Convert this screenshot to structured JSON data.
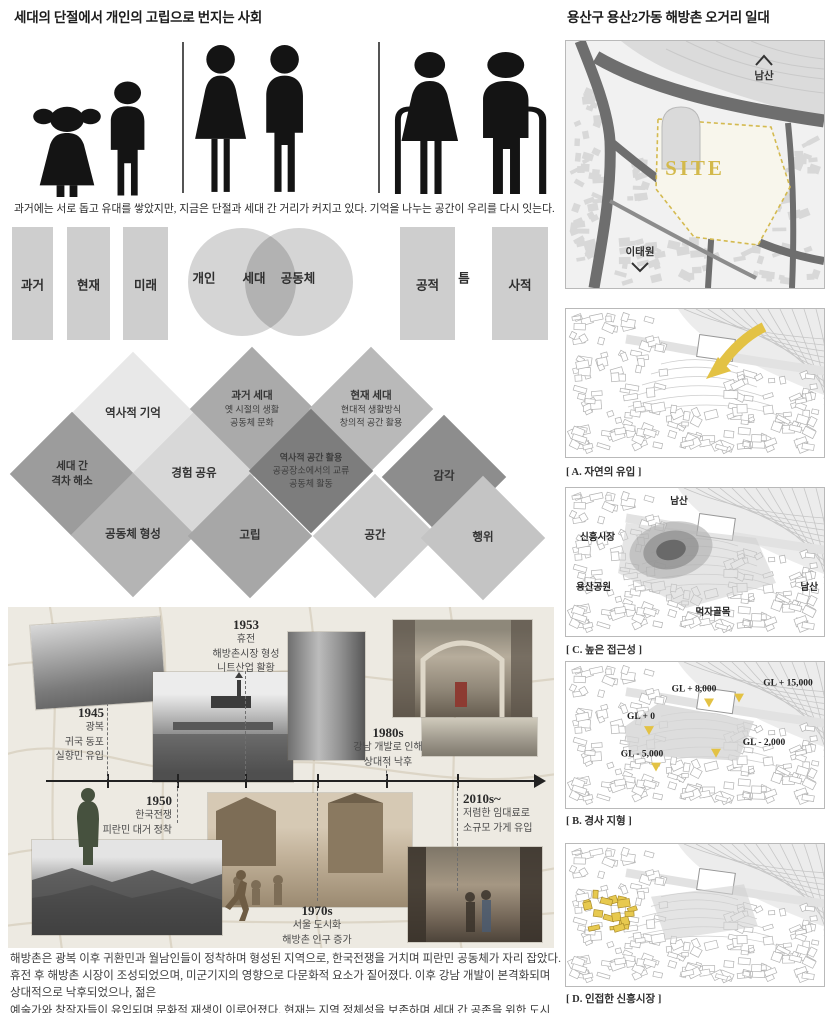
{
  "colors": {
    "accent_yellow": "#e3c244",
    "site_label_yellow": "#d3b94b",
    "figure_black": "#141414",
    "diagram_grays": [
      "#e8e8e8",
      "#cecece",
      "#b4b4b4",
      "#9c9c9c",
      "#7d7d7d"
    ],
    "collage_beige": "#edeae2"
  },
  "left": {
    "title": "세대의 단절에서 개인의 고립으로 번지는 사회",
    "pictogram_caption": "과거에는 서로 돕고 유대를 쌓았지만, 지금은 단절과 세대 간 거리가 커지고 있다. 기억을 나누는 공간이 우리를 다시 잇는다.",
    "concept": {
      "time_blocks": [
        "과거",
        "현재",
        "미래"
      ],
      "venn": {
        "left": "개인",
        "center": "세대",
        "right": "공동체"
      },
      "zone_blocks": [
        "공적",
        "틈",
        "사적"
      ]
    },
    "diamonds": [
      {
        "lines": [
          "역사적 기억"
        ]
      },
      {
        "lines": [
          "세대 간",
          "격차 해소"
        ]
      },
      {
        "lines": [
          "경험 공유"
        ]
      },
      {
        "lines": [
          "공동체 형성"
        ]
      },
      {
        "lines": [
          "과거 세대",
          "옛 시절의 생활",
          "공동체 문화"
        ]
      },
      {
        "lines": [
          "현재 세대",
          "현대적 생활방식",
          "창의적 공간 활용"
        ]
      },
      {
        "lines": [
          "역사적 공간 활용",
          "공공장소에서의 교류",
          "공동체 활동"
        ]
      },
      {
        "lines": [
          "고립"
        ]
      },
      {
        "lines": [
          "공간"
        ]
      },
      {
        "lines": [
          "감각"
        ]
      },
      {
        "lines": [
          "행위"
        ]
      }
    ],
    "timeline": {
      "events": [
        {
          "year": "1945",
          "lines": [
            "광복",
            "귀국 동포",
            "실향민 유입"
          ]
        },
        {
          "year": "1953",
          "lines": [
            "휴전",
            "해방촌시장 형성",
            "니트산업 활황"
          ]
        },
        {
          "year": "1950",
          "lines": [
            "한국전쟁",
            "피란민 대거 정착"
          ]
        },
        {
          "year": "1970s",
          "lines": [
            "서울 도시화",
            "해방촌 인구 증가"
          ]
        },
        {
          "year": "1980s",
          "lines": [
            "강남 개발로 인해",
            "상대적 낙후"
          ]
        },
        {
          "year": "2010s~",
          "lines": [
            "저렴한 임대료로",
            "소규모 가게 유입"
          ]
        }
      ]
    },
    "summary": [
      "해방촌은 광복 이후 귀환민과 월남인들이 정착하며 형성된 지역으로, 한국전쟁을 거치며 피란민 공동체가 자리 잡았다.",
      "휴전 후 해방촌 시장이 조성되었으며, 미군기지의 영향으로 다문화적 요소가 짙어졌다. 이후 강남 개발이 본격화되며 상대적으로 낙후되었으나, 젊은",
      "예술가와 창작자들이 유입되며 문화적 재생이 이루어졌다. 현재는 지역 정체성을 보존하며 세대 간 공존을 위한 도시 재생이 진행 중이다."
    ]
  },
  "right": {
    "title": "용산구 용산2가동 해방촌 오거리 일대",
    "map": {
      "site": "SITE",
      "namsan": "남산",
      "itaewon": "이태원"
    },
    "panel_a": {
      "caption": "[ A. 자연의 유입 ]"
    },
    "panel_c": {
      "caption": "[ C. 높은 접근성 ]",
      "labels": {
        "top": "남산",
        "left": "신흥시장",
        "bottom_left": "용산공원",
        "right": "남산",
        "bottom": "먹자골목"
      }
    },
    "panel_b": {
      "caption": "[ B. 경사 지형 ]",
      "gl": [
        "GL + 8,000",
        "GL + 15,000",
        "GL + 0",
        "GL - 2,000",
        "GL - 5,000"
      ]
    },
    "panel_d": {
      "caption": "[ D. 인접한 신흥시장 ]"
    }
  }
}
